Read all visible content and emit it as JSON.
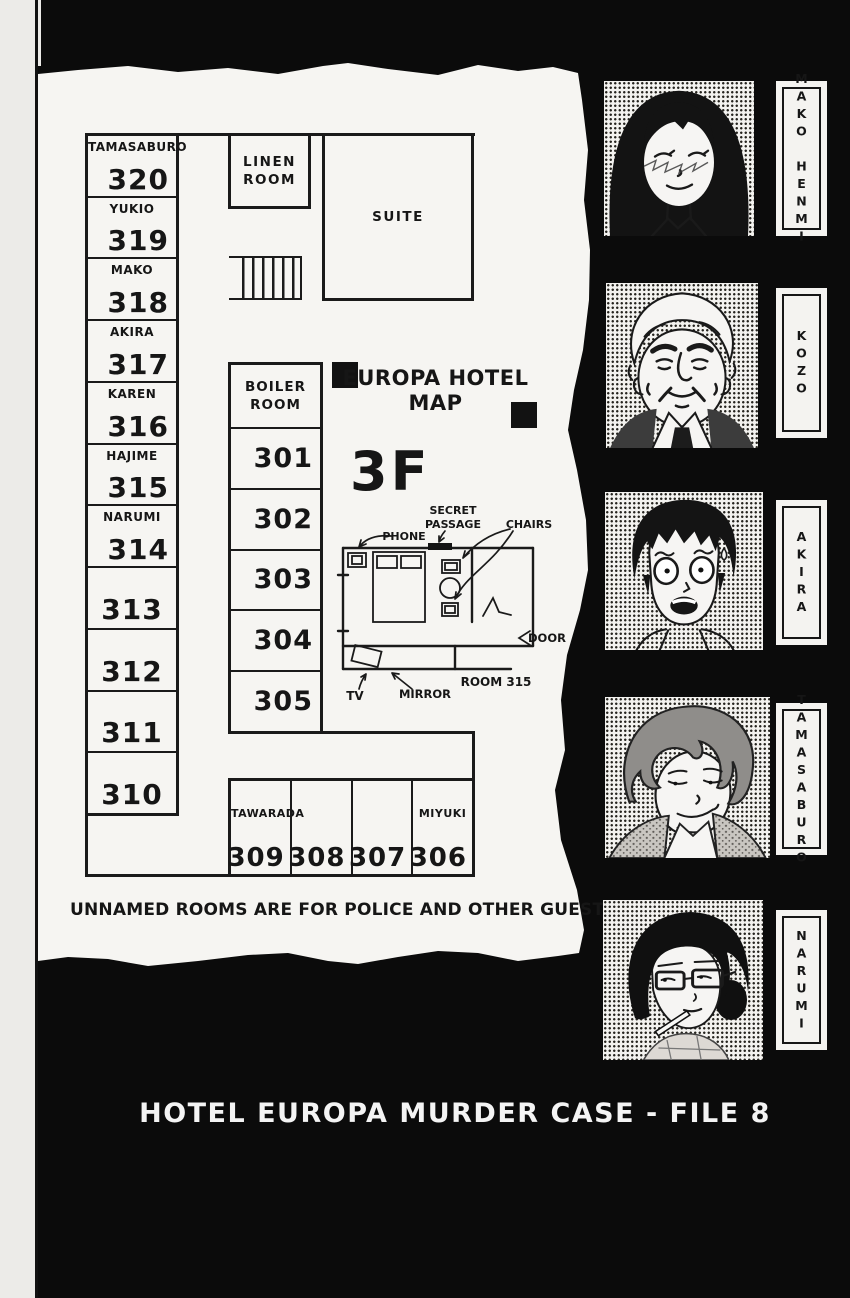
{
  "page": {
    "note": "UNNAMED ROOMS ARE FOR POLICE AND OTHER GUESTS",
    "footer": "HOTEL EUROPA MURDER CASE - FILE 8"
  },
  "map": {
    "title_lines": [
      "EUROPA HOTEL",
      "MAP"
    ],
    "floor": "3F",
    "suite_label": "SUITE",
    "linen_label": "LINEN ROOM",
    "boiler_label": "BOILER ROOM",
    "left_rooms": [
      {
        "name": "TAMASABURO",
        "number": "320"
      },
      {
        "name": "YUKIO",
        "number": "319"
      },
      {
        "name": "MAKO",
        "number": "318"
      },
      {
        "name": "AKIRA",
        "number": "317"
      },
      {
        "name": "KAREN",
        "number": "316"
      },
      {
        "name": "HAJIME",
        "number": "315"
      },
      {
        "name": "NARUMI",
        "number": "314"
      },
      {
        "name": "",
        "number": "313"
      },
      {
        "name": "",
        "number": "312"
      },
      {
        "name": "",
        "number": "311"
      },
      {
        "name": "",
        "number": "310"
      }
    ],
    "middle_rooms": [
      "301",
      "302",
      "303",
      "304",
      "305"
    ],
    "bottom_rooms": [
      {
        "name": "TAWARADA",
        "number": "309"
      },
      {
        "name": "",
        "number": "308"
      },
      {
        "name": "",
        "number": "307"
      },
      {
        "name": "MIYUKI",
        "number": "306"
      }
    ],
    "detail": {
      "room_label": "ROOM 315",
      "phone": "PHONE",
      "secret_lines": [
        "SECRET",
        "PASSAGE"
      ],
      "chairs": "CHAIRS",
      "door": "DOOR",
      "mirror": "MIRROR",
      "tv": "TV"
    }
  },
  "characters": [
    {
      "name": "MAKO HENMI"
    },
    {
      "name": "KOZO"
    },
    {
      "name": "AKIRA"
    },
    {
      "name": "TAMASABURO"
    },
    {
      "name": "NARUMI"
    }
  ],
  "colors": {
    "paper": "#f6f5f2",
    "ink": "#161616",
    "background": "#0b0b0b"
  }
}
